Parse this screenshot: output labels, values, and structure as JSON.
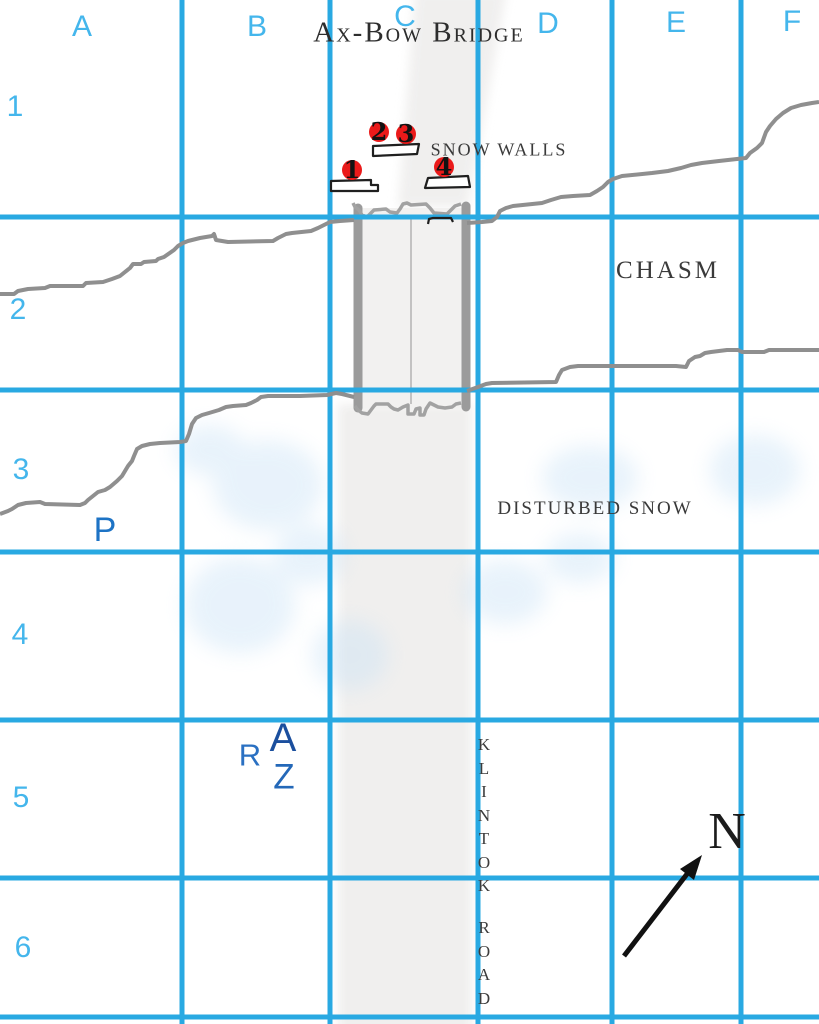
{
  "map_title": "Ax-Bow Bridge",
  "grid": {
    "columns": [
      {
        "label": "A"
      },
      {
        "label": "B"
      },
      {
        "label": "C"
      },
      {
        "label": "D"
      },
      {
        "label": "E"
      },
      {
        "label": "F"
      }
    ],
    "rows": [
      {
        "label": "1"
      },
      {
        "label": "2"
      },
      {
        "label": "3"
      },
      {
        "label": "4"
      },
      {
        "label": "5"
      },
      {
        "label": "6"
      }
    ]
  },
  "features": {
    "snow_walls": "SNOW WALLS",
    "chasm": "CHASM",
    "disturbed_snow": "DISTURBED SNOW",
    "road_name_line1": "KLINTOK",
    "road_name_line2": "ROAD"
  },
  "markers": [
    {
      "label": "1"
    },
    {
      "label": "2"
    },
    {
      "label": "3"
    },
    {
      "label": "4"
    }
  ],
  "tokens": {
    "p": "P",
    "r": "R",
    "a": "A",
    "z": "Z"
  },
  "compass": {
    "north_label": "N"
  },
  "colors": {
    "grid_line": "#29a9e2",
    "grid_label": "#44b6ec",
    "chasm_line": "#8f8f8f",
    "bridge_gray": "#9b9b9b",
    "marker_red": "#ea1a1a",
    "token_p": "#1d73c5",
    "token_r": "#2a70c2",
    "token_a": "#1b4f9e",
    "token_z": "#2468b8",
    "map_text": "#3a3a3a",
    "snow_tint": "#c9e2f6"
  }
}
